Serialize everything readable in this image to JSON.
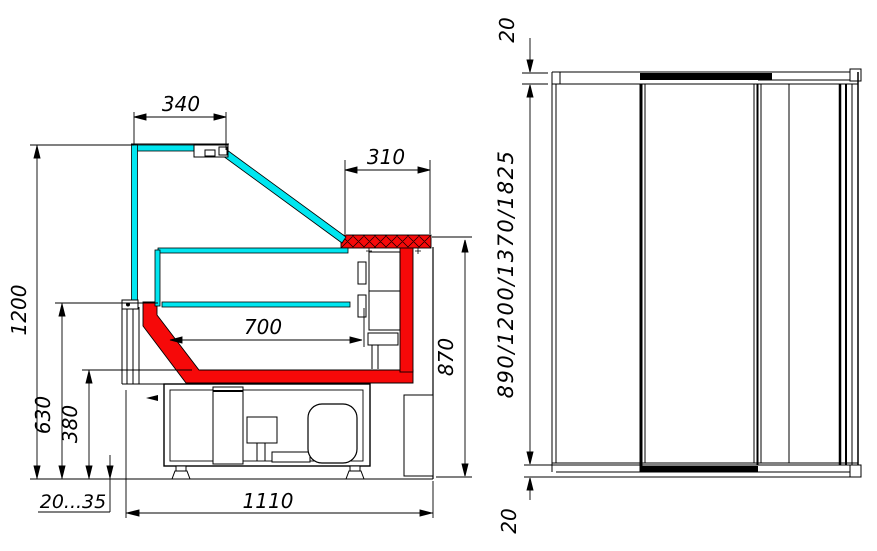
{
  "colors": {
    "glass_cyan": "#00e6f0",
    "body_red": "#f60909",
    "line_black": "#000000",
    "background": "#ffffff"
  },
  "section_view": {
    "dim_canopy_depth": "340",
    "dim_countertop_depth": "310",
    "dim_overall_height": "1200",
    "dim_well_height": "630",
    "dim_base_height": "380",
    "dim_well_width": "700",
    "dim_counter_height": "870",
    "dim_foot_adjust_range": "20...35",
    "dim_overall_depth": "1110"
  },
  "side_view": {
    "dim_top_panel": "20",
    "dim_body_heights": "890/1200/1370/1825",
    "dim_bottom_panel": "20"
  }
}
